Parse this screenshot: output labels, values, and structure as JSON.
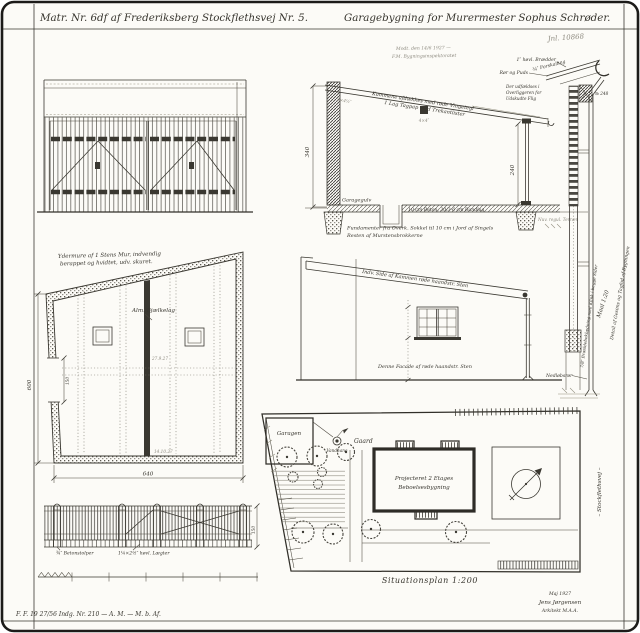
{
  "page": {
    "paper": "#fcfbf7",
    "ink": "#3a3831",
    "pencil": "#8e8b80"
  },
  "header": {
    "left_title": "Matr. Nr. 6df af Frederiksberg Stockflethsvej Nr. 5.",
    "right_title": "Garagebygning for Murermester Sophus Schrøder.",
    "journal_no": "Jnl. 10868",
    "pencil_line1": "Modt. den 14/6 1927 —",
    "pencil_line2": "F.M. Bygningsinspektoratet"
  },
  "plan": {
    "wall_note_1": "Ydermure af 1 Stens Mur, indvendig",
    "wall_note_2": "berappet og hvidtet, udv. skuret.",
    "beam_note": "Alm. Bjælkelag",
    "height_dim": "600",
    "width_dim": "640",
    "door_dim": "150",
    "date_1": "27.9.27",
    "date_2": "14.10.27"
  },
  "section": {
    "roof_note_1": "Kammene afdækkes med røde Vingetegl",
    "roof_note_2": "1 Lag Tagpap med Trekantlister",
    "rafter_dim": "2×4½″",
    "purlin_dim": "4×4″",
    "height_dim": "340",
    "inner_height_dim": "240",
    "floor_label": "Garagegulv",
    "slab_note": "10 cm Beton, 30/3-6 cm Bundlag",
    "foundation_note_1": "Fundamenter fra Overk. Sokkel til 10 cm i Jord af Singels",
    "foundation_note_2": "Resten af Murstensbrokkerne",
    "terrain_note": "Nuv. regul. Terræn"
  },
  "detail": {
    "board_note": "1″ høvl. Brædder",
    "reed_note": "Rør og Puds",
    "lath_note": "¾″ Forskalling",
    "overhang_note_1": "Der udfældses i",
    "overhang_note_2": "Overliggeren for",
    "overhang_note_3": "Udskudte Flig",
    "number_note": "№ 248",
    "scale_note": "Maal 1:20",
    "edge_note": "Detail af Gesims og Tagfod af Bygningen",
    "cladding_note": "7/8″ Bræddebeklædning med Klink i begge Sider",
    "downpipe_note": "Nedløbsrør"
  },
  "side_elevation": {
    "coping_note": "Indv. Side af Kammen røde haandstr. Sten",
    "facade_note": "Denne Facade af røde haandstr. Sten"
  },
  "fence": {
    "post_note": "¾″ Betonstolper",
    "lath_note": "1¼×2½″ høvl. Lægter",
    "height_dim": "150"
  },
  "site_plan": {
    "garage_label": "Garagen",
    "tap_label": "Vandhane",
    "yard_label": "Gaard",
    "building_line1": "Projecteret 2 Etages",
    "building_line2": "Beboelsesbygning",
    "caption": "Situationsplan 1:200",
    "street_label": "– Stockflethsvej –"
  },
  "title_block": {
    "registration": "F. F. 19 27/56 Indg. Nr. 210 — A. M. — M. b. Af.",
    "date": "Maj 1927",
    "signature": "Jens Jørgensen",
    "profession": "Arkitekt M.A.A."
  }
}
